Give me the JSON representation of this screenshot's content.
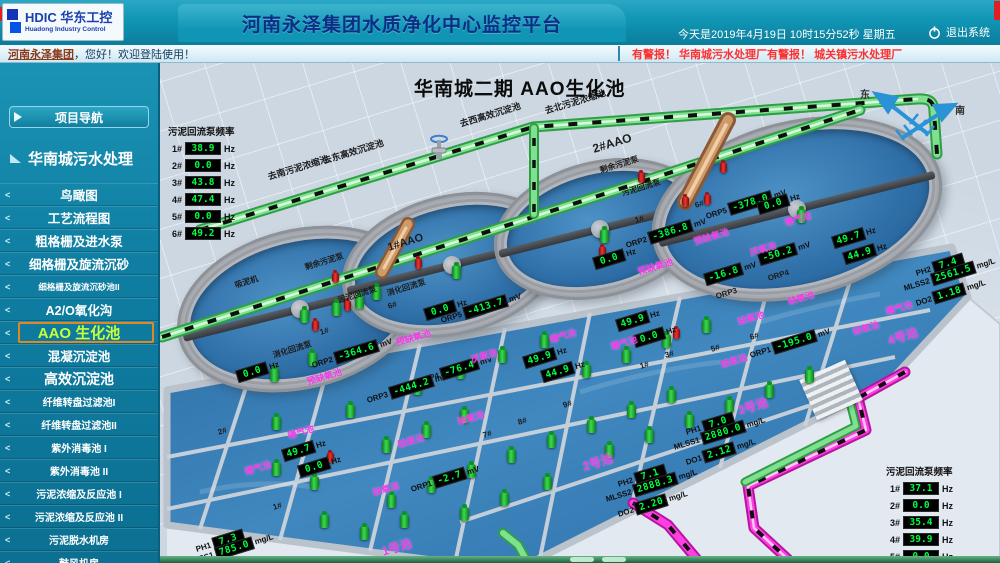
{
  "header": {
    "logo_hdic": "HDIC 华东工控",
    "logo_en": "Huadong Industry Control",
    "title": "河南永泽集团水质净化中心监控平台",
    "datetime": "今天是2019年4月19日  10时15分52秒   星期五",
    "logout_label": "退出系统",
    "welcome_link": "河南永泽集团",
    "welcome_rest": "，您好！欢迎登陆使用！",
    "alarm": "有警报！ 华南城污水处理厂有警报！  城关镇污水处理厂"
  },
  "sidebar": {
    "nav_button": "项目导航",
    "section": "华南城污水处理",
    "items": [
      {
        "label": "鸟瞰图",
        "size": "md"
      },
      {
        "label": "工艺流程图",
        "size": "md"
      },
      {
        "label": "粗格栅及进水泵",
        "size": "md"
      },
      {
        "label": "细格栅及旋流沉砂",
        "size": "md"
      },
      {
        "label": "细格栅及旋流沉砂池II",
        "size": "xs"
      },
      {
        "label": "A2/O氧化沟",
        "size": "md"
      },
      {
        "label": "AAO 生化池",
        "size": "lg",
        "active": true
      },
      {
        "label": "混凝沉淀池",
        "size": "md"
      },
      {
        "label": "高效沉淀池",
        "size": "lg"
      },
      {
        "label": "纤维转盘过滤池I",
        "size": "sm"
      },
      {
        "label": "纤维转盘过滤池II",
        "size": "sm"
      },
      {
        "label": "紫外消毒池 I",
        "size": "sm"
      },
      {
        "label": "紫外消毒池 II",
        "size": "sm"
      },
      {
        "label": "污泥浓缩及反应池 I",
        "size": "sm"
      },
      {
        "label": "污泥浓缩及反应池 II",
        "size": "sm"
      },
      {
        "label": "污泥脱水机房",
        "size": "sm"
      },
      {
        "label": "鼓风机房",
        "size": "sm"
      }
    ]
  },
  "scene": {
    "title": "华南城二期 AAO生化池",
    "compass": {
      "east": "东",
      "south": "南"
    },
    "left_panel": {
      "title": "污泥回流泵频率",
      "unit": "Hz",
      "rows": [
        {
          "n": "1#",
          "v": "38.9"
        },
        {
          "n": "2#",
          "v": "0.0"
        },
        {
          "n": "3#",
          "v": "43.8"
        },
        {
          "n": "4#",
          "v": "47.4"
        },
        {
          "n": "5#",
          "v": "0.0"
        },
        {
          "n": "6#",
          "v": "49.2"
        }
      ]
    },
    "right_panel": {
      "title": "污泥回流泵频率",
      "unit": "Hz",
      "rows": [
        {
          "n": "1#",
          "v": "37.1"
        },
        {
          "n": "2#",
          "v": "0.0"
        },
        {
          "n": "3#",
          "v": "35.4"
        },
        {
          "n": "4#",
          "v": "39.9"
        },
        {
          "n": "5#",
          "v": "0.0"
        },
        {
          "n": "6#",
          "v": "38.1"
        }
      ]
    },
    "readouts": [
      {
        "l": "",
        "v": "0.0",
        "u": "Hz",
        "x": 75,
        "y": 309
      },
      {
        "l": "ORP2",
        "v": "-364.6",
        "u": "mV",
        "x": 152,
        "y": 297
      },
      {
        "l": "",
        "v": "0.0",
        "u": "Hz",
        "x": 263,
        "y": 247
      },
      {
        "l": "ORP5",
        "v": "-413.7",
        "u": "mV",
        "x": 281,
        "y": 252
      },
      {
        "l": "ORP4",
        "v": "-76.4",
        "u": "mV",
        "x": 258,
        "y": 313
      },
      {
        "l": "ORP3",
        "v": "-444.2",
        "u": "mV",
        "x": 207,
        "y": 332
      },
      {
        "l": "",
        "v": "49.9",
        "u": "Hz",
        "x": 362,
        "y": 295
      },
      {
        "l": "",
        "v": "44.9",
        "u": "Hz",
        "x": 380,
        "y": 309
      },
      {
        "l": "",
        "v": "49.9",
        "u": "Hz",
        "x": 455,
        "y": 258
      },
      {
        "l": "",
        "v": "0.0",
        "u": "Hz",
        "x": 472,
        "y": 274
      },
      {
        "l": "",
        "v": "0.0",
        "u": "Hz",
        "x": 432,
        "y": 196
      },
      {
        "l": "ORP2",
        "v": "-386.8",
        "u": "mV",
        "x": 466,
        "y": 177
      },
      {
        "l": "ORP5",
        "v": "-378.0",
        "u": "mV",
        "x": 546,
        "y": 148
      },
      {
        "l": "",
        "v": "0.0",
        "u": "Hz",
        "x": 596,
        "y": 141
      },
      {
        "l": "",
        "v": "-50.2",
        "u": "mV",
        "x": 597,
        "y": 192
      },
      {
        "l": "",
        "v": "-16.8",
        "u": "mV",
        "x": 543,
        "y": 212
      },
      {
        "l": "",
        "v": "49.7",
        "u": "Hz",
        "x": 671,
        "y": 175
      },
      {
        "l": "",
        "v": "44.9",
        "u": "Hz",
        "x": 682,
        "y": 191
      },
      {
        "l": "PH2",
        "v": "7.4",
        "u": "",
        "x": 756,
        "y": 205
      },
      {
        "l": "MLSS2",
        "v": "2561.5",
        "u": "mg/L",
        "x": 744,
        "y": 220
      },
      {
        "l": "DO2",
        "v": "1.18",
        "u": "mg/L",
        "x": 756,
        "y": 235
      },
      {
        "l": "ORP1",
        "v": "-195.0",
        "u": "mV",
        "x": 590,
        "y": 287
      },
      {
        "l": "PH1",
        "v": "7.0",
        "u": "",
        "x": 526,
        "y": 364
      },
      {
        "l": "MLSS1",
        "v": "2880.0",
        "u": "mg/L",
        "x": 514,
        "y": 379
      },
      {
        "l": "DO1",
        "v": "2.12",
        "u": "mg/L",
        "x": 526,
        "y": 394
      },
      {
        "l": "PH2",
        "v": "7.1",
        "u": "",
        "x": 458,
        "y": 416
      },
      {
        "l": "MLSS2",
        "v": "2888.3",
        "u": "mg/L",
        "x": 446,
        "y": 431
      },
      {
        "l": "DO2",
        "v": "2.20",
        "u": "mg/L",
        "x": 458,
        "y": 446
      },
      {
        "l": "ORP1",
        "v": "-2.7",
        "u": "mV",
        "x": 251,
        "y": 421
      },
      {
        "l": "",
        "v": "49.7",
        "u": "Hz",
        "x": 121,
        "y": 388
      },
      {
        "l": "",
        "v": "0.0",
        "u": "Hz",
        "x": 137,
        "y": 404
      },
      {
        "l": "PH1",
        "v": "7.3",
        "u": "",
        "x": 36,
        "y": 481
      },
      {
        "l": "MLSS1",
        "v": "785.0",
        "u": "mg/L",
        "x": 28,
        "y": 494
      }
    ],
    "zone_labels": [
      {
        "t": "预缺氧池",
        "x": 147,
        "y": 313,
        "s": 9
      },
      {
        "t": "预缺氧池",
        "x": 236,
        "y": 274,
        "s": 9
      },
      {
        "t": "预缺氧池",
        "x": 478,
        "y": 203,
        "s": 9
      },
      {
        "t": "预缺氧池",
        "x": 534,
        "y": 173,
        "s": 9
      },
      {
        "t": "厌氧池",
        "x": 311,
        "y": 291,
        "s": 9
      },
      {
        "t": "厌氧池",
        "x": 590,
        "y": 184,
        "s": 9
      },
      {
        "t": "缺氧池",
        "x": 298,
        "y": 353,
        "s": 9
      },
      {
        "t": "缺氧池",
        "x": 578,
        "y": 253,
        "s": 9
      },
      {
        "t": "缺氧池",
        "x": 561,
        "y": 296,
        "s": 9
      },
      {
        "t": "缺氧池",
        "x": 628,
        "y": 233,
        "s": 9
      },
      {
        "t": "缺氧池",
        "x": 693,
        "y": 263,
        "s": 9
      },
      {
        "t": "缺氧池",
        "x": 213,
        "y": 424,
        "s": 9
      },
      {
        "t": "缺氧池",
        "x": 238,
        "y": 376,
        "s": 9
      },
      {
        "t": "曝气池",
        "x": 390,
        "y": 271,
        "s": 9
      },
      {
        "t": "曝气池",
        "x": 451,
        "y": 278,
        "s": 9
      },
      {
        "t": "曝气池",
        "x": 625,
        "y": 154,
        "s": 9
      },
      {
        "t": "曝气池",
        "x": 726,
        "y": 243,
        "s": 9
      },
      {
        "t": "曝气池",
        "x": 128,
        "y": 367,
        "s": 9
      },
      {
        "t": "曝气池",
        "x": 85,
        "y": 403,
        "s": 9
      },
      {
        "t": "1号池",
        "x": 222,
        "y": 481,
        "s": 12
      },
      {
        "t": "2号池",
        "x": 423,
        "y": 396,
        "s": 12
      },
      {
        "t": "3号池",
        "x": 578,
        "y": 340,
        "s": 12
      },
      {
        "t": "4号池",
        "x": 728,
        "y": 270,
        "s": 12
      }
    ],
    "equip_labels": [
      {
        "t": "去西高效沉淀池",
        "x": 300,
        "y": 55,
        "s": 9
      },
      {
        "t": "去北污泥浓缩池",
        "x": 385,
        "y": 42,
        "s": 9
      },
      {
        "t": "去东高效沉淀池",
        "x": 163,
        "y": 92,
        "s": 9
      },
      {
        "t": "去南污泥浓缩池",
        "x": 108,
        "y": 108,
        "s": 9
      },
      {
        "t": "1#AAO",
        "x": 228,
        "y": 180,
        "s": 11
      },
      {
        "t": "2#AAO",
        "x": 433,
        "y": 80,
        "s": 12
      },
      {
        "t": "吸泥机",
        "x": 75,
        "y": 218,
        "s": 8
      },
      {
        "t": "剩余污泥泵",
        "x": 145,
        "y": 200,
        "s": 8
      },
      {
        "t": "污泥回流泵",
        "x": 178,
        "y": 233,
        "s": 8
      },
      {
        "t": "消化回流泵",
        "x": 113,
        "y": 288,
        "s": 8
      },
      {
        "t": "消化回流泵",
        "x": 227,
        "y": 226,
        "s": 8
      },
      {
        "t": "剩余污泥泵",
        "x": 440,
        "y": 103,
        "s": 8
      },
      {
        "t": "污泥回流泵",
        "x": 462,
        "y": 126,
        "s": 8
      },
      {
        "t": "ORP4",
        "x": 608,
        "y": 212,
        "s": 8
      },
      {
        "t": "ORP3",
        "x": 556,
        "y": 230,
        "s": 8
      },
      {
        "t": "1#",
        "x": 160,
        "y": 266,
        "s": 8
      },
      {
        "t": "6#",
        "x": 228,
        "y": 240,
        "s": 8
      },
      {
        "t": "1#",
        "x": 475,
        "y": 154,
        "s": 8
      },
      {
        "t": "6#",
        "x": 535,
        "y": 139,
        "s": 8
      },
      {
        "t": "1#",
        "x": 480,
        "y": 300,
        "s": 8
      },
      {
        "t": "3#",
        "x": 505,
        "y": 289,
        "s": 8
      },
      {
        "t": "5#",
        "x": 551,
        "y": 283,
        "s": 8
      },
      {
        "t": "6#",
        "x": 590,
        "y": 271,
        "s": 8
      },
      {
        "t": "7#",
        "x": 323,
        "y": 369,
        "s": 8
      },
      {
        "t": "8#",
        "x": 358,
        "y": 356,
        "s": 8
      },
      {
        "t": "9#",
        "x": 403,
        "y": 339,
        "s": 8
      },
      {
        "t": "1#",
        "x": 113,
        "y": 441,
        "s": 8
      },
      {
        "t": "2#",
        "x": 58,
        "y": 366,
        "s": 8
      }
    ],
    "pumps": [
      [
        140,
        247
      ],
      [
        292,
        203
      ],
      [
        440,
        167
      ],
      [
        637,
        147
      ],
      [
        195,
        233
      ],
      [
        212,
        224
      ],
      [
        172,
        240
      ],
      [
        110,
        306
      ],
      [
        148,
        290
      ],
      [
        186,
        342
      ],
      [
        112,
        354
      ],
      [
        253,
        319
      ],
      [
        296,
        303
      ],
      [
        338,
        287
      ],
      [
        380,
        272
      ],
      [
        300,
        347
      ],
      [
        262,
        362
      ],
      [
        222,
        377
      ],
      [
        112,
        400
      ],
      [
        150,
        414
      ],
      [
        227,
        432
      ],
      [
        267,
        417
      ],
      [
        307,
        402
      ],
      [
        347,
        387
      ],
      [
        387,
        372
      ],
      [
        427,
        357
      ],
      [
        467,
        342
      ],
      [
        507,
        327
      ],
      [
        422,
        302
      ],
      [
        462,
        287
      ],
      [
        502,
        272
      ],
      [
        542,
        257
      ],
      [
        445,
        382
      ],
      [
        485,
        367
      ],
      [
        525,
        352
      ],
      [
        565,
        337
      ],
      [
        605,
        322
      ],
      [
        645,
        307
      ],
      [
        160,
        452
      ],
      [
        200,
        464
      ],
      [
        240,
        452
      ],
      [
        300,
        445
      ],
      [
        340,
        430
      ],
      [
        383,
        414
      ]
    ],
    "leds": [
      [
        172,
        210
      ],
      [
        184,
        238
      ],
      [
        152,
        258
      ],
      [
        478,
        110
      ],
      [
        522,
        134
      ],
      [
        544,
        132
      ],
      [
        600,
        134
      ],
      [
        439,
        184
      ],
      [
        513,
        266
      ],
      [
        167,
        390
      ],
      [
        255,
        196
      ],
      [
        560,
        100
      ]
    ]
  },
  "colors": {
    "led_green": "#00ff41",
    "zone_pink": "#f23ae6",
    "pipe_green": "#7fe08f",
    "pipe_magenta": "#ff3fe3",
    "pipe_brown": "#cf9a6a",
    "alarm_red": "#ff2f2f",
    "header_teal": "#1095b4"
  }
}
